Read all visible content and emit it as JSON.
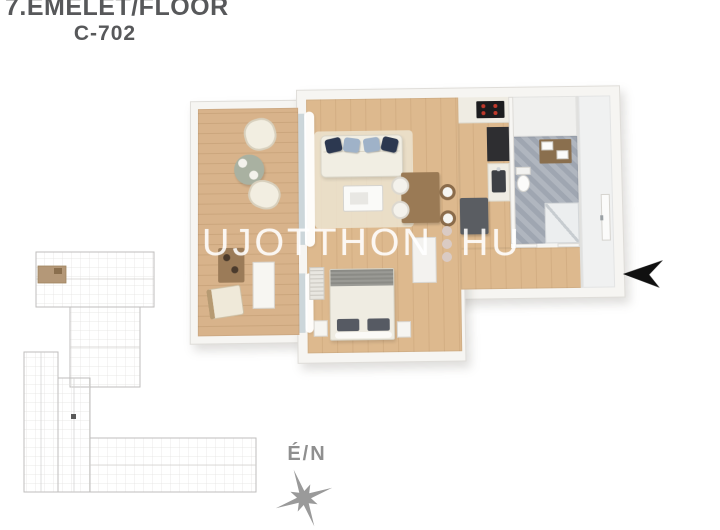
{
  "header": {
    "floor_label": "7.EMELET/FLOOR",
    "unit_label": "C-702"
  },
  "watermark": {
    "name_part": "UJOTTHON",
    "tld_part": "HU",
    "separator": "three-vertical-dots"
  },
  "compass": {
    "label": "É/N",
    "icon": "eight-point-compass-rose"
  },
  "entrance": {
    "icon": "entrance-arrow",
    "direction": "points-left-at-entry-door"
  },
  "minimap": {
    "description": "building-site-plan-outline",
    "highlight_color": "#b49878",
    "line_color": "#bfbebc"
  },
  "palette": {
    "title_text": "#57585a",
    "wall": "#f6f5f2",
    "interior_wood": "#ddb98e",
    "terrace_wood": "#d8b38b",
    "bathroom_tile": "#a7aeb8",
    "kitchen_dark": "#2e2e31",
    "island_gray": "#5a5d62",
    "sofa_cream": "#f1eee3",
    "pillow_navy": "#2c3850",
    "pillow_blue": "#9fb2c8",
    "terrace_table_green": "#a9b1a1",
    "watermark_text": "rgba(255,255,255,0.82)",
    "watermark_dot": "#d9cbc7",
    "compass_gray": "#9a9a9a",
    "entrance_arrow": "#101010"
  }
}
